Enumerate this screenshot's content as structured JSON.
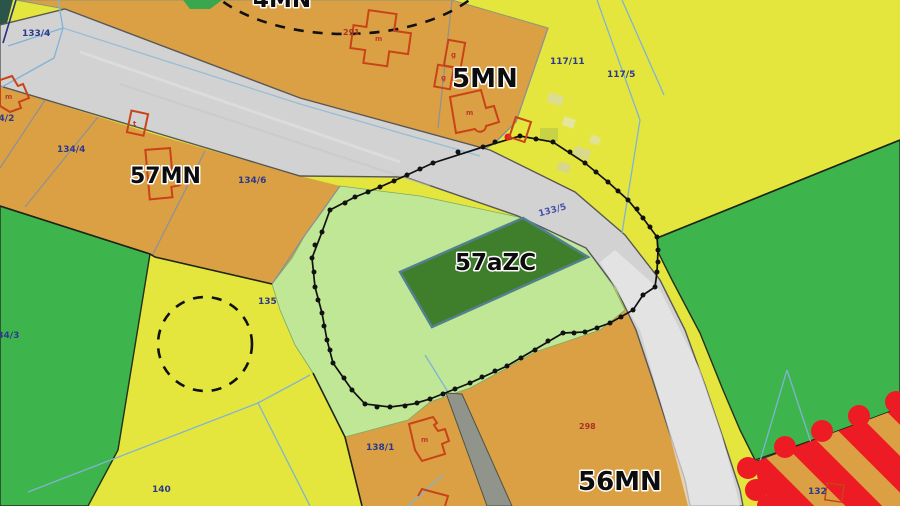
{
  "map_title": "zoning-cadastral-map",
  "zones": {
    "mn4": "4MN",
    "mn5": "5MN",
    "mn57": "57MN",
    "azc57": "57aZC",
    "mn56": "56MN"
  },
  "parcels": {
    "p133_4": "133/4",
    "p134_2": "134/2",
    "p134_4": "134/4",
    "p134_6": "134/6",
    "p134_3": "134/3",
    "p117_11": "117/11",
    "p117_5": "117/5",
    "p133_5": "133/5",
    "p135": "135",
    "p138_1": "138/1",
    "p140": "140",
    "p132": "132"
  },
  "red_labels": {
    "r291": "291",
    "r298": "298"
  },
  "building_letters": {
    "m": "m",
    "t": "t",
    "g": "g"
  },
  "colors": {
    "orange_zone": "#dba044",
    "yellow_zone": "#e4e63d",
    "green_zone": "#3eb44d",
    "lightgreen_zone": "#bfe795",
    "darkgreen_patch": "#3f7e2a",
    "road": "#d2d2d2",
    "hatch_red": "#ed1c24",
    "boundary_black": "#111111",
    "parcel_label_navy": "#2c3a8c",
    "building_red": "#c94318"
  }
}
